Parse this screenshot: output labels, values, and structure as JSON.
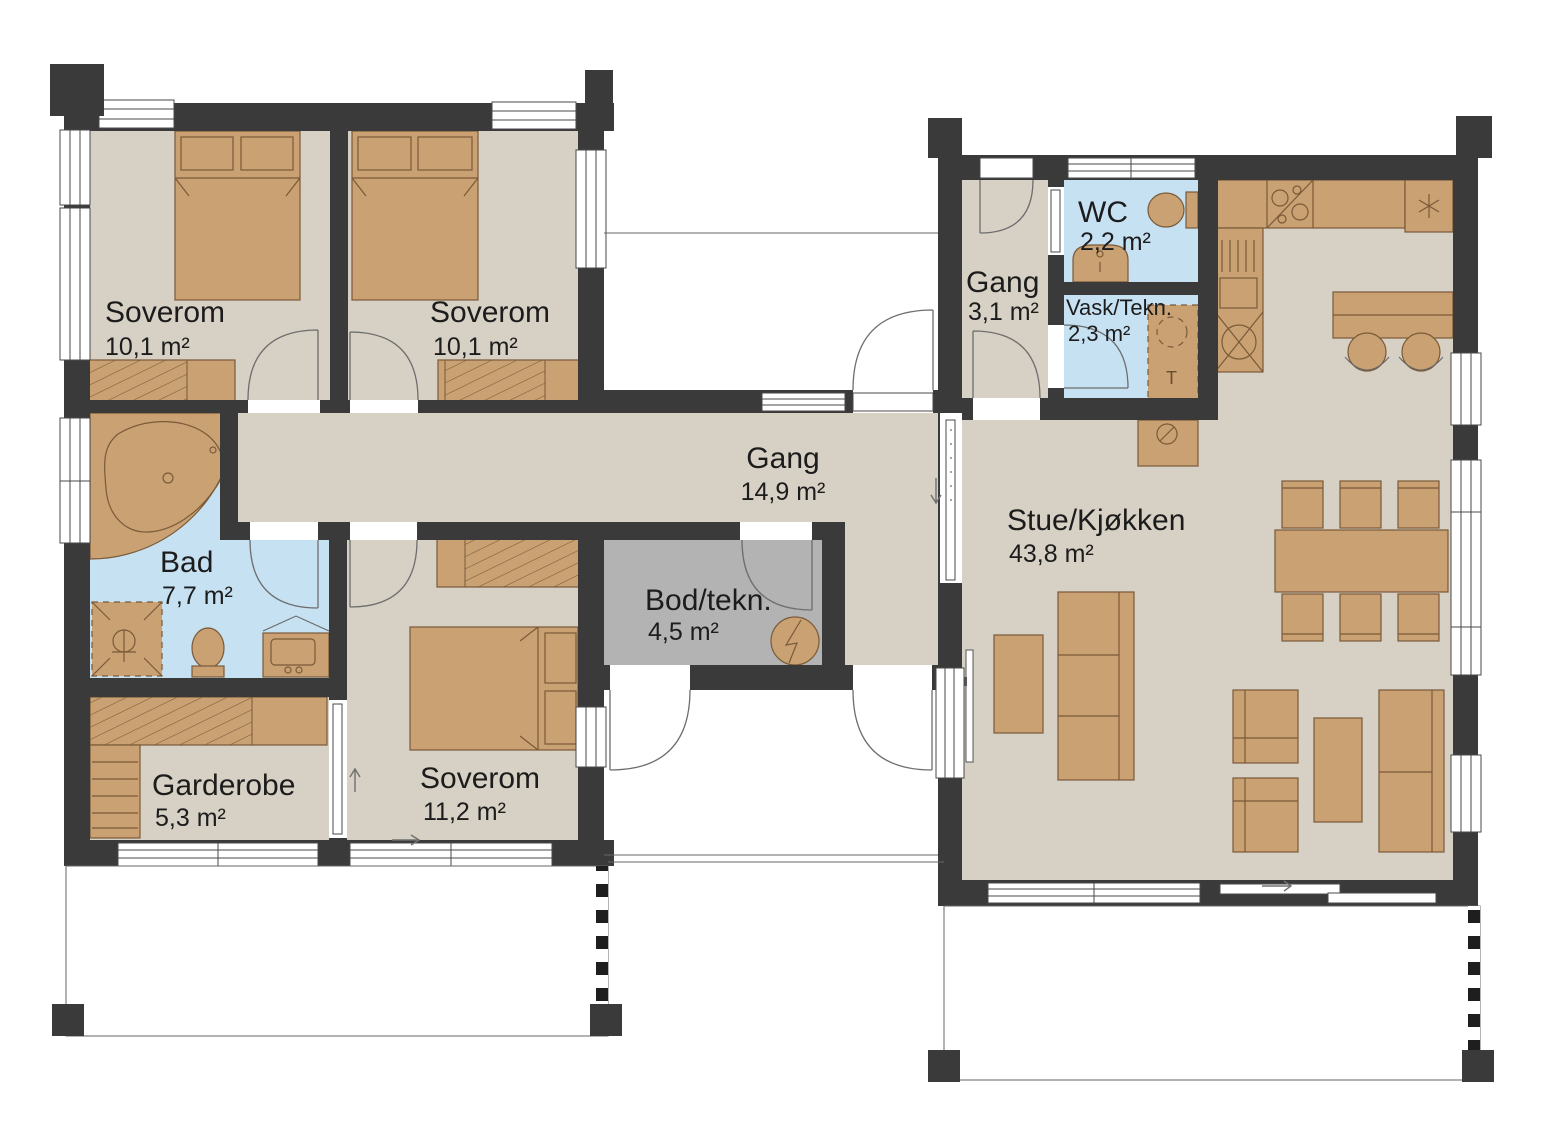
{
  "plan": {
    "title": "House floor plan",
    "rooms": [
      {
        "name": "Soverom",
        "area": "10,1 m²",
        "furniture": [
          "double-bed",
          "wardrobe"
        ]
      },
      {
        "name": "Soverom",
        "area": "10,1 m²",
        "furniture": [
          "double-bed",
          "wardrobe"
        ]
      },
      {
        "name": "Gang",
        "area": "14,9 m²",
        "furniture": []
      },
      {
        "name": "Bad",
        "area": "7,7 m²",
        "furniture": [
          "corner-bathtub",
          "shower",
          "toilet",
          "vanity-sink"
        ]
      },
      {
        "name": "Garderobe",
        "area": "5,3 m²",
        "furniture": [
          "wardrobe",
          "shelf-cabinet"
        ]
      },
      {
        "name": "Soverom",
        "area": "11,2 m²",
        "furniture": [
          "double-bed",
          "wardrobe"
        ]
      },
      {
        "name": "Bod/tekn.",
        "area": "4,5 m²",
        "furniture": [
          "water-heater"
        ]
      },
      {
        "name": "Gang",
        "area": "3,1 m²",
        "furniture": []
      },
      {
        "name": "WC",
        "area": "2,2 m²",
        "furniture": [
          "toilet",
          "sink"
        ]
      },
      {
        "name": "Vask/Tekn.",
        "area": "2,3 m²",
        "furniture": [
          "washing-machine"
        ]
      },
      {
        "name": "Stue/Kjøkken",
        "area": "43,8 m²",
        "furniture": [
          "kitchen-counter",
          "cooktop",
          "fridge-freezer",
          "island-with-barstools",
          "fireplace",
          "dining-table-6-chairs",
          "tv",
          "tv-bench",
          "sofa-3-seat",
          "armchairs",
          "coffee-table",
          "sofa-2-seat"
        ]
      }
    ],
    "appliance_labels": {
      "dryer": "T"
    },
    "colors": {
      "wall": "#3a3a3a",
      "floor": "#d7d0c4",
      "wet_room": "#c6e1f2",
      "storage_room": "#b3b3b3",
      "furniture": "#c9a173",
      "furniture_outline": "#7a5a38"
    }
  }
}
